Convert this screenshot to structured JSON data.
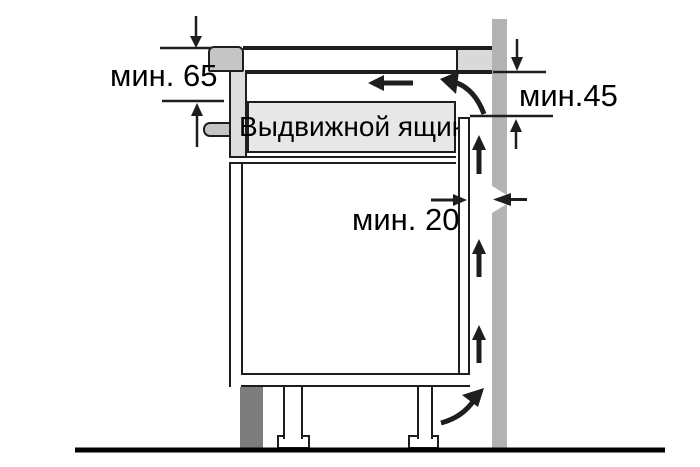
{
  "labels": {
    "min65": "мин. 65",
    "min45": "мин.45",
    "min20": "мин. 20",
    "drawer": "Выдвижной ящик"
  },
  "colors": {
    "line": "#1e1e1e",
    "bg": "#ffffff",
    "hob": "#c5c5c5",
    "housing": "#dedede",
    "drawer-fill": "#e7e7e7",
    "counter-block": "#d9d9d9",
    "wall": "#b3b3b3",
    "plinth": "#7d7d7d"
  }
}
